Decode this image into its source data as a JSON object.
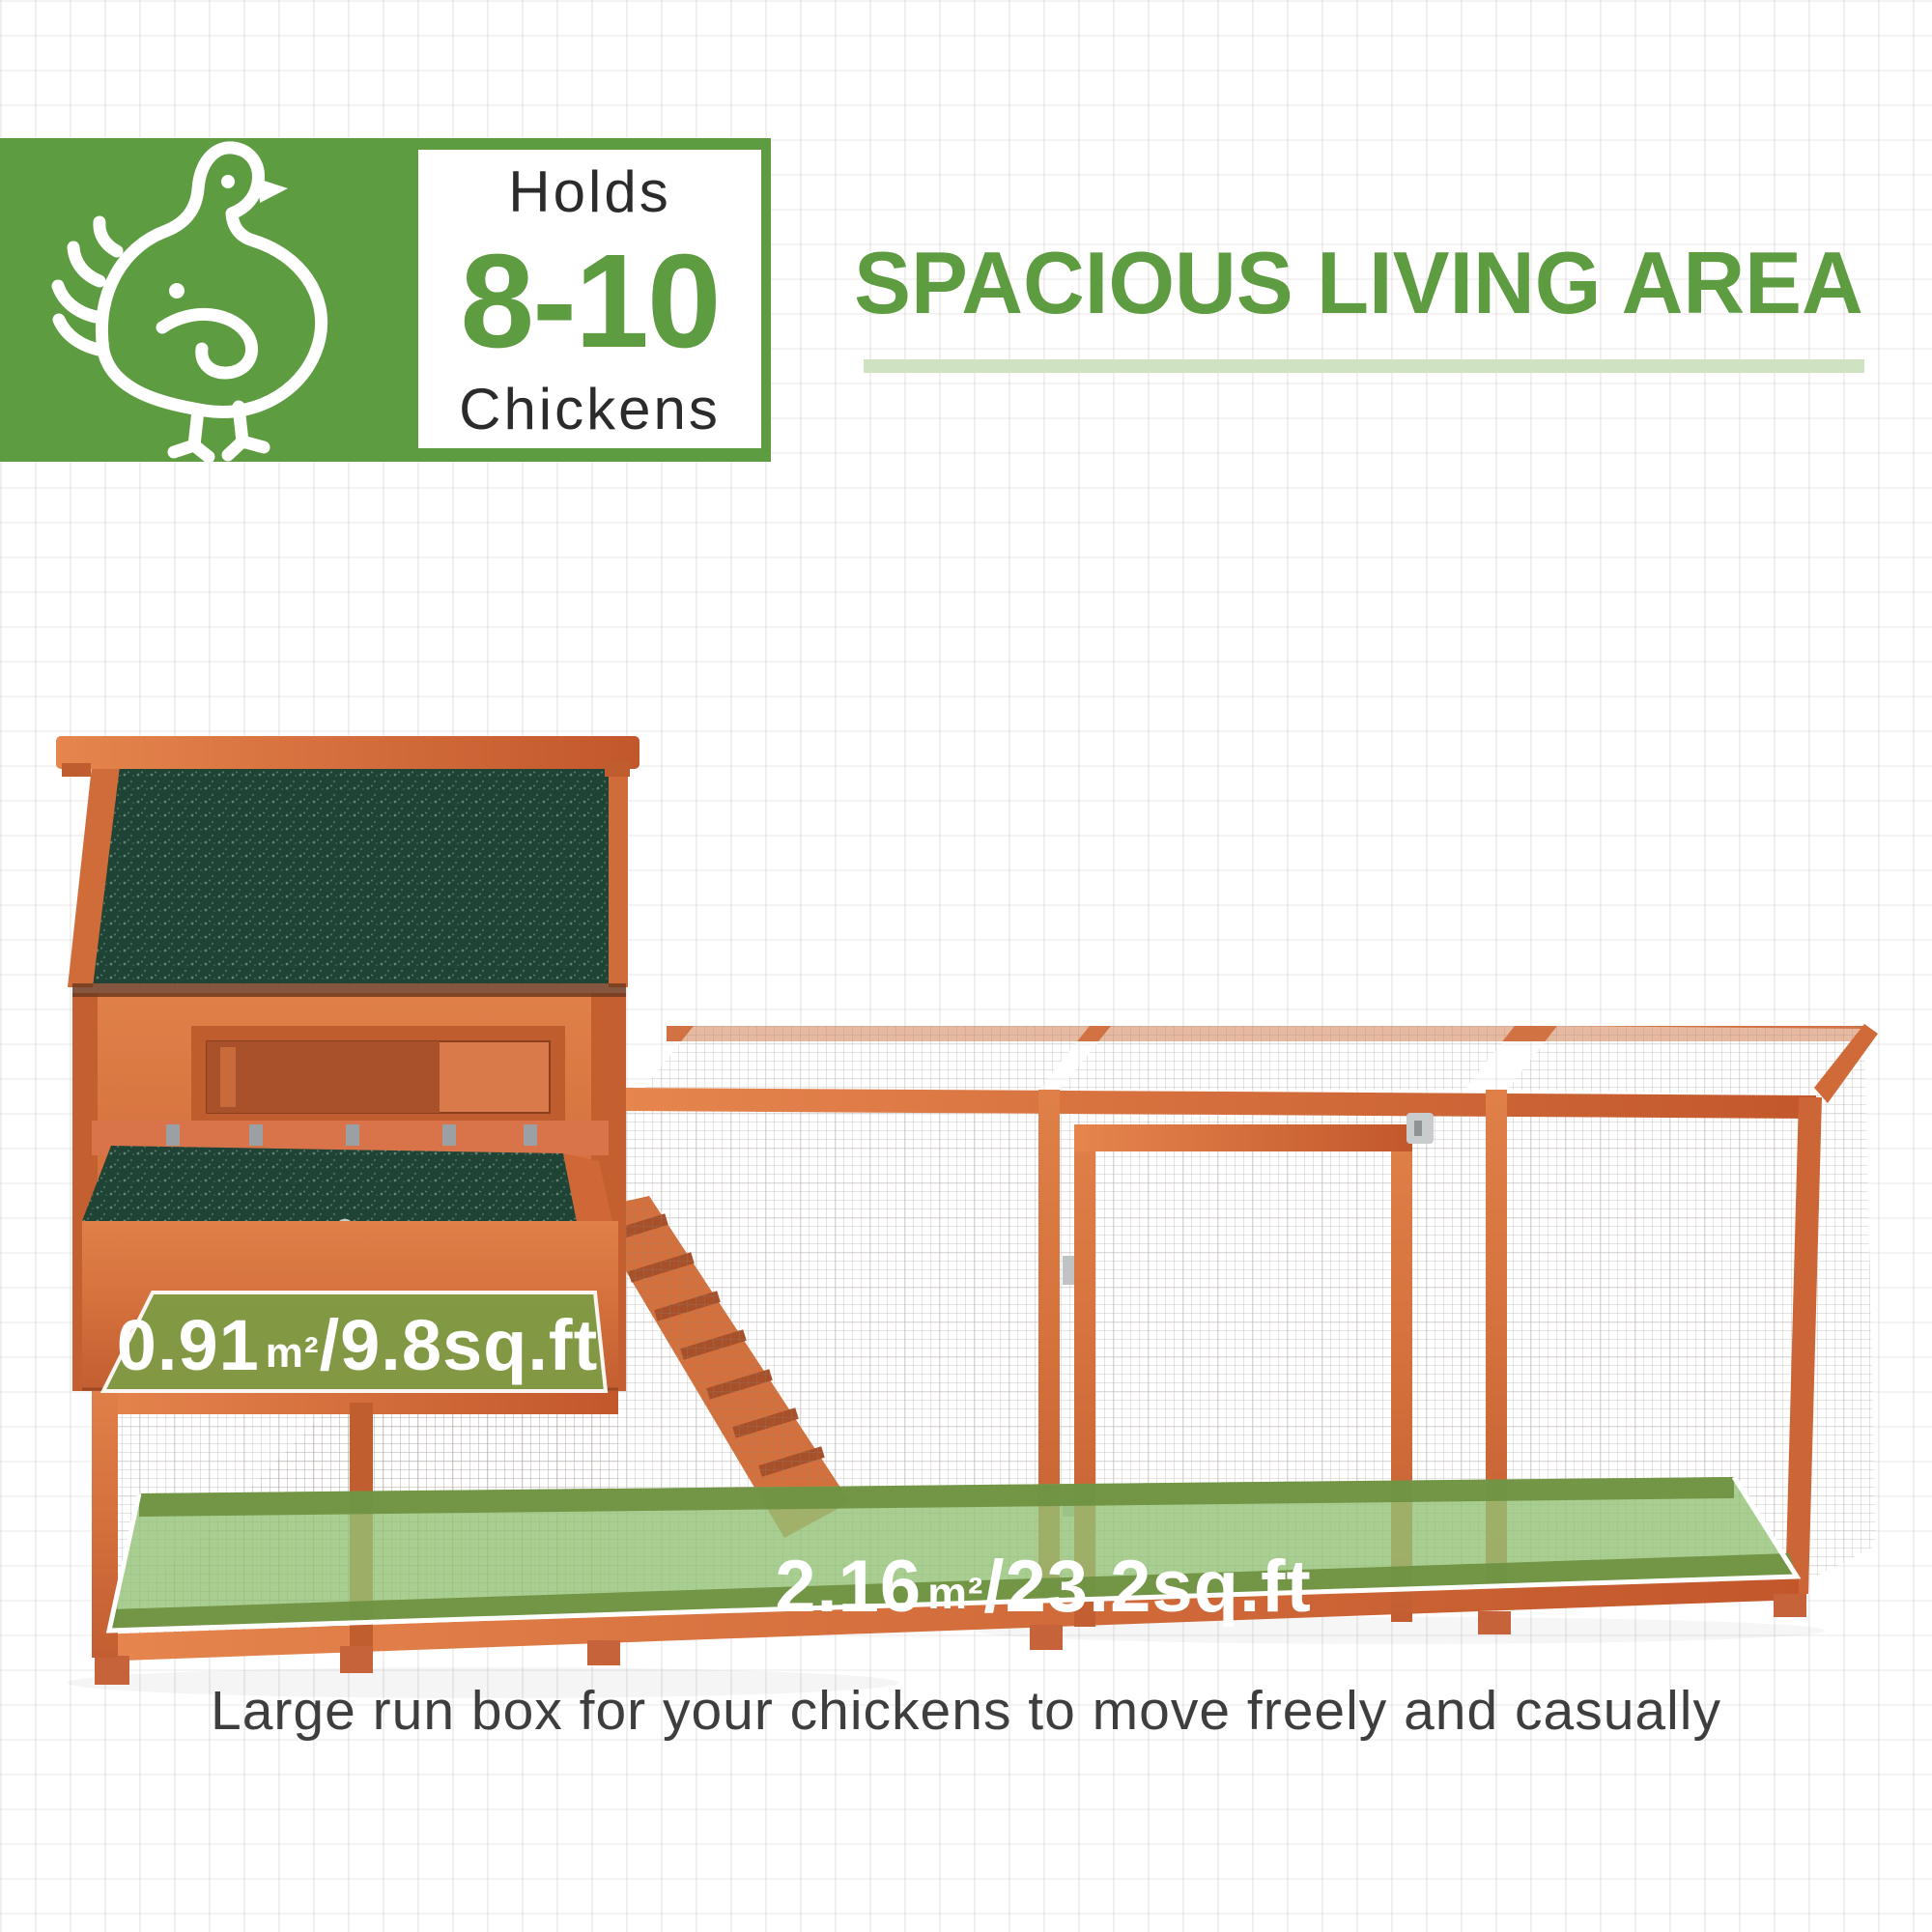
{
  "header": {
    "badge": {
      "line1": "Holds",
      "number": "8-10",
      "line2": "Chickens",
      "icon": "chicken-icon"
    },
    "title": "SPACIOUS LIVING AREA"
  },
  "overlays": {
    "coop_area": {
      "metric_value": "0.91",
      "metric_unit": "m²",
      "imperial": "/9.8sq.ft"
    },
    "run_area": {
      "metric_value": "2.16",
      "metric_unit": "m²",
      "imperial": "/23.2sq.ft"
    }
  },
  "caption": "Large run box for your chickens to move freely and casually",
  "colors": {
    "brand_green": "#5d9c40",
    "underline_green": "#cfe3c3",
    "roof_green": "#1f4334",
    "wood_orange": "#d4703c",
    "overlay_olive": "#7e9c45",
    "floor_green": "#93c276"
  }
}
